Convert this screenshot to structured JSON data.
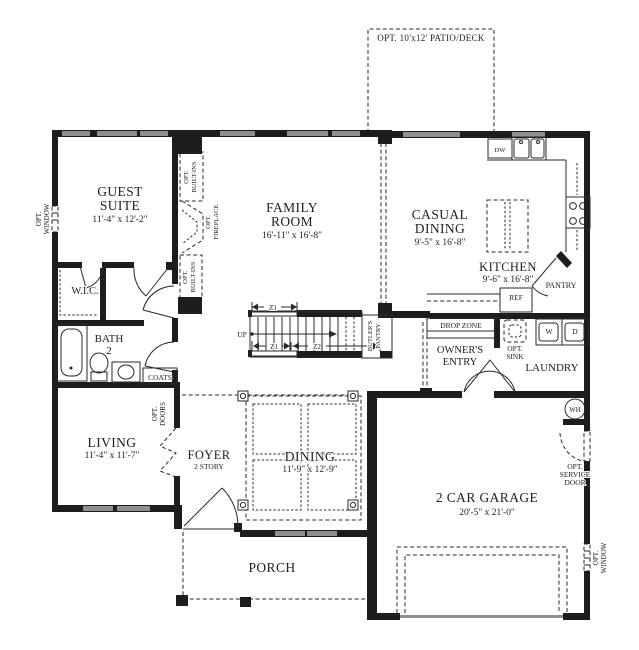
{
  "colors": {
    "wall": "#1d1d1d",
    "window": "#8f8f8f",
    "text": "#222222",
    "background": "#ffffff"
  },
  "patio": {
    "label": "OPT. 10'x12' PATIO/DECK"
  },
  "rooms": {
    "guest_suite": {
      "line1": "GUEST",
      "line2": "SUITE",
      "dims": "11'-4\" x 12'-2\""
    },
    "family_room": {
      "line1": "FAMILY",
      "line2": "ROOM",
      "dims": "16'-11\" x 16'-8\""
    },
    "casual_dining": {
      "line1": "CASUAL",
      "line2": "DINING",
      "dims": "9'-5\" x 16'-8\""
    },
    "kitchen": {
      "name": "KITCHEN",
      "dims": "9'-6\" x 16'-8\""
    },
    "wic": {
      "name": "W.I.C."
    },
    "bath": {
      "line1": "BATH",
      "line2": "2"
    },
    "living": {
      "name": "LIVING",
      "dims": "11'-4\" x 11'-7\""
    },
    "foyer": {
      "name": "FOYER",
      "sub": "2 STORY"
    },
    "dining": {
      "name": "DINING",
      "dims": "11'-9\" x 12'-9\""
    },
    "porch": {
      "name": "PORCH"
    },
    "garage": {
      "name": "2 CAR GARAGE",
      "dims": "20'-5\" x 21'-0\""
    },
    "owners_entry": {
      "line1": "OWNER'S",
      "line2": "ENTRY"
    },
    "laundry": {
      "name": "LAUNDRY"
    }
  },
  "features": {
    "opt_window_left": {
      "line1": "OPT.",
      "line2": "WINDOW"
    },
    "opt_window_right": {
      "line1": "OPT.",
      "line2": "WINDOW"
    },
    "opt_builtins_top": {
      "line1": "OPT.",
      "line2": "BUILT-INS"
    },
    "opt_builtins_bottom": {
      "line1": "OPT.",
      "line2": "BUILT-INS"
    },
    "opt_fireplace": {
      "line1": "OPT.",
      "line2": "FIREPLACE"
    },
    "opt_doors": {
      "line1": "OPT.",
      "line2": "DOORS"
    },
    "opt_service_door": {
      "line1": "OPT.",
      "line2": "SERVICE",
      "line3": "DOOR"
    },
    "opt_sink": {
      "line1": "OPT.",
      "line2": "SINK"
    },
    "butlers_pantry": {
      "line1": "BUTLER'S",
      "line2": "PANTRY"
    },
    "drop_zone": "DROP ZONE",
    "pantry": "PANTRY",
    "coats": "COATS",
    "ref": "REF",
    "dw": "DW",
    "washer": "W",
    "dryer": "D",
    "water_heater": "WH",
    "up": "UP",
    "z1_top": "Z1",
    "z1_bottom": "Z1",
    "z2": "Z2"
  }
}
